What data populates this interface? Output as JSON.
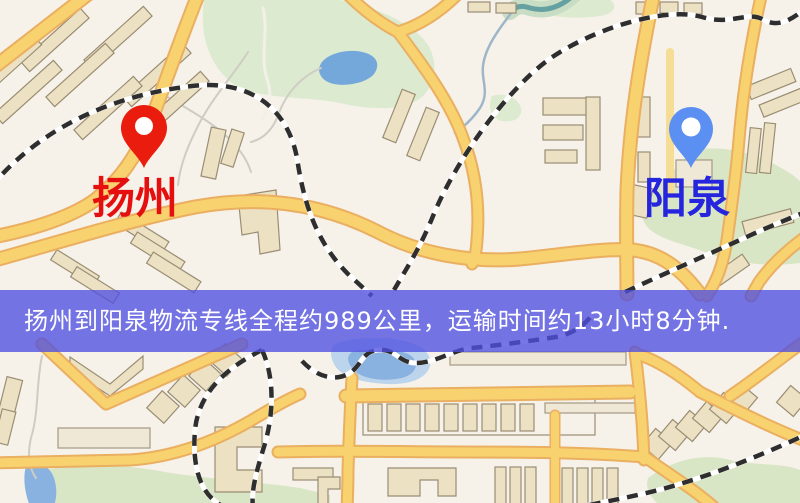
{
  "banner": {
    "text": "扬州到阳泉物流专线全程约989公里，运输时间约13小时8分钟.",
    "background_color": "#5050e0",
    "text_color": "#ffffff"
  },
  "route": {
    "origin": "扬州",
    "destination": "阳泉",
    "distance_text": "989公里",
    "duration_text": "13小时8分钟"
  },
  "pins": {
    "origin": {
      "label": "扬州",
      "pin_color": "#ea1c0d",
      "label_color": "#e60f0f",
      "icon": "location-pin-icon"
    },
    "destination": {
      "label": "阳泉",
      "pin_color": "#5b8ff2",
      "label_color": "#2525dd",
      "icon": "location-pin-icon"
    }
  },
  "map": {
    "background_color": "#f6f2ea",
    "road_color": "#f8d26e",
    "park_color": "#d9e6c5",
    "water_color": "#74a7da",
    "railway_color": "#2e2e2e"
  }
}
